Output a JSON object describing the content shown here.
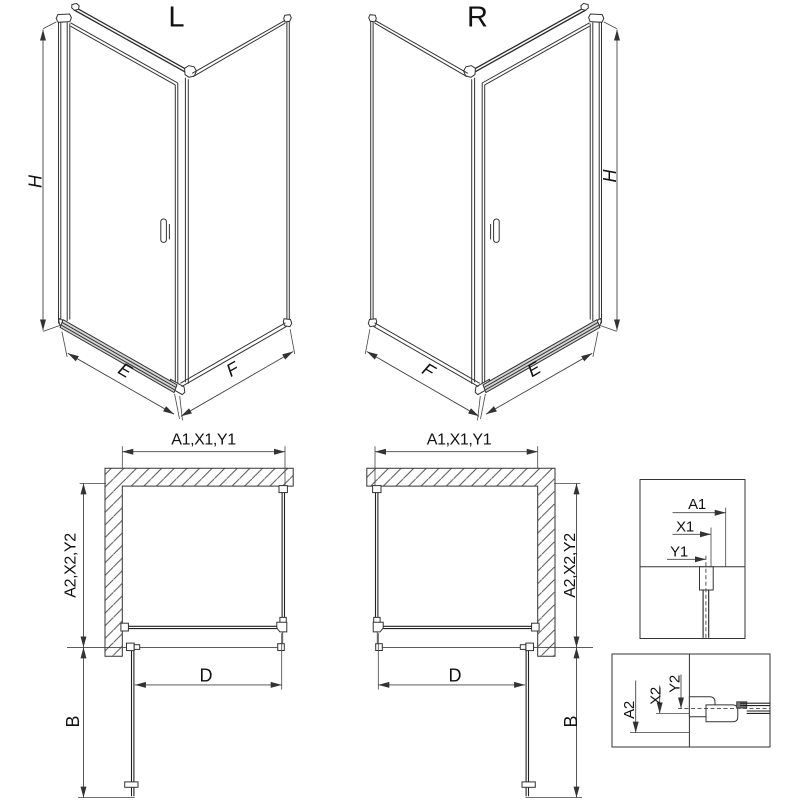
{
  "drawing": {
    "background": "#ffffff",
    "line_color": "#333333",
    "text_color": "#111111",
    "iso_left": {
      "variant": "L",
      "height_dim": "H",
      "door_width_dim": "E",
      "panel_depth_dim": "F"
    },
    "iso_right": {
      "variant": "R",
      "height_dim": "H",
      "door_width_dim": "E",
      "panel_depth_dim": "F"
    },
    "plan_left": {
      "wall_dim_top": "A1,X1,Y1",
      "wall_dim_side": "A2,X2,Y2",
      "door_clear_dim": "D",
      "door_open_dim": "B"
    },
    "plan_right": {
      "wall_dim_top": "A1,X1,Y1",
      "wall_dim_side": "A2,X2,Y2",
      "door_clear_dim": "D",
      "door_open_dim": "B"
    },
    "detail_top": {
      "dim_a": "A1",
      "dim_x": "X1",
      "dim_y": "Y1"
    },
    "detail_bottom": {
      "dim_a": "A2",
      "dim_x": "X2",
      "dim_y": "Y2"
    }
  }
}
